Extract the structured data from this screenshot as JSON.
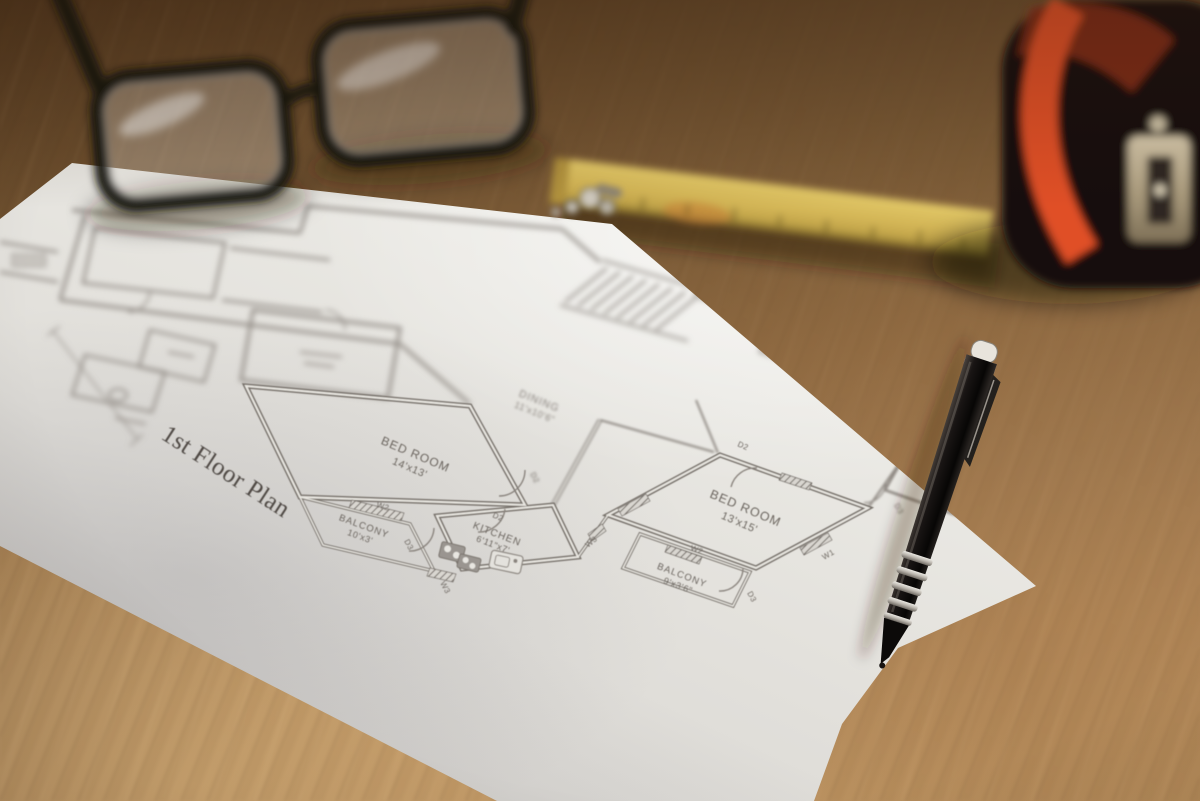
{
  "floor_plan": {
    "title": "1st Floor Plan",
    "rooms": [
      {
        "name": "BED ROOM",
        "dims": "14'x13'"
      },
      {
        "name": "BALCONY",
        "dims": "10'x3'"
      },
      {
        "name": "KITCHEN",
        "dims": "6'11\"x7'"
      },
      {
        "name": "DINING",
        "dims": "11'x10'6\""
      },
      {
        "name": "BED ROOM",
        "dims": "13'x15'"
      },
      {
        "name": "BALCONY",
        "dims": "9'x3'6\""
      },
      {
        "name": "BED ROOM",
        "dims": "13'x13'9\""
      },
      {
        "name": "BALCONY",
        "dims": "10'x3'6\""
      }
    ],
    "markers": {
      "w1": "W1",
      "w2": "W2",
      "w3": "W3",
      "d2": "D2",
      "d3": "D3"
    }
  },
  "colors": {
    "paper": "#edebe6",
    "wood_mid": "#96714a",
    "plan_line": "#77716b",
    "tape_accent": "#e04f28",
    "ruler_yellow": "#d9c35e",
    "pen_body": "#15110f"
  }
}
